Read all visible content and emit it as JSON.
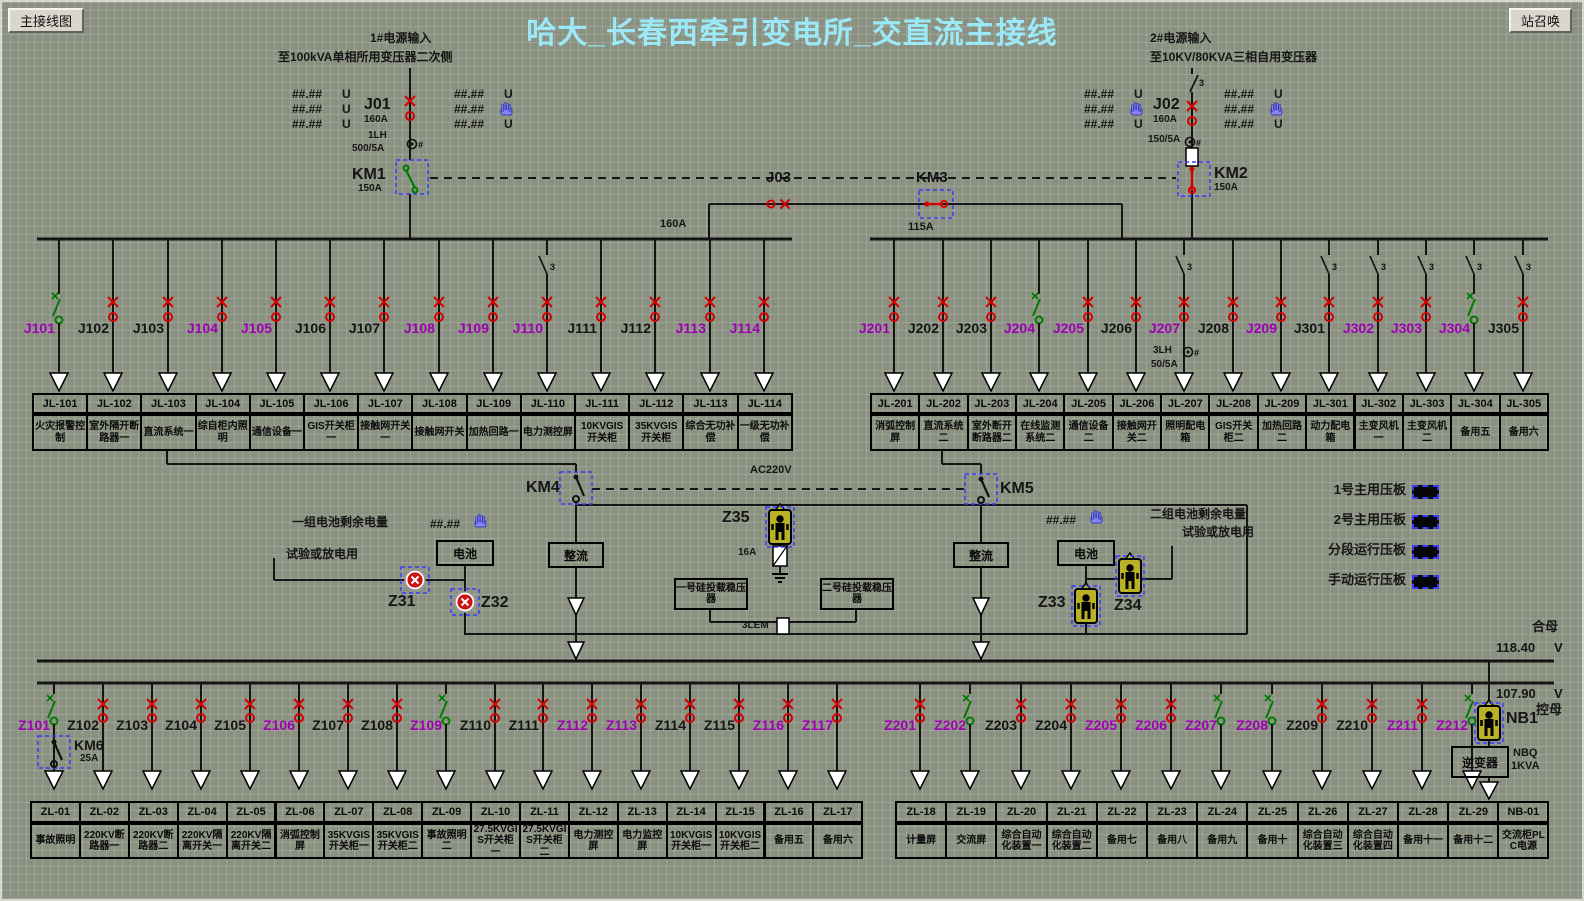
{
  "sym": {
    "three": "3",
    "hash": "#"
  },
  "header": {
    "left_button": "主接线图",
    "right_button": "站召唤",
    "title": "哈大_长春西牵引变电所_交直流主接线"
  },
  "feed1": {
    "name": "1#电源输入",
    "dest": "至100kVA单相所用变压器二次侧",
    "j": "J01",
    "j_amp": "160A",
    "ct": "1LH",
    "ct_ratio": "500/5A",
    "km": "KM1",
    "km_amp": "150A",
    "unit": "U",
    "meas_l": [
      "##.##",
      "##.##",
      "##.##"
    ],
    "meas_r": [
      "##.##",
      "##.##",
      "##.##"
    ]
  },
  "feed2": {
    "name": "2#电源输入",
    "dest": "至10KV/80KVA三相自用变压器",
    "j": "J02",
    "j_amp": "160A",
    "ct_ratio": "150/5A",
    "km": "KM2",
    "km_amp": "150A",
    "unit": "U",
    "meas_l": [
      "##.##",
      "##.##",
      "##.##"
    ],
    "meas_r": [
      "##.##",
      "##.##",
      "##.##"
    ]
  },
  "tie": {
    "j": "J03",
    "km": "KM3",
    "amp_left": "160A",
    "amp_right": "115A"
  },
  "bus1_feeders": [
    {
      "j": "J101",
      "jc": "m",
      "sw": "open",
      "box": "JL-101",
      "desc": "火灾报警控制"
    },
    {
      "j": "J102",
      "jc": "k",
      "sw": "closed",
      "box": "JL-102",
      "desc": "室外隔开断路器一"
    },
    {
      "j": "J103",
      "jc": "k",
      "sw": "closed",
      "box": "JL-103",
      "desc": "直流系统一"
    },
    {
      "j": "J104",
      "jc": "m",
      "sw": "closed",
      "box": "JL-104",
      "desc": "综自柜内照明"
    },
    {
      "j": "J105",
      "jc": "m",
      "sw": "closed",
      "box": "JL-105",
      "desc": "通信设备一"
    },
    {
      "j": "J106",
      "jc": "k",
      "sw": "closed",
      "box": "JL-106",
      "desc": "GIS开关柜一"
    },
    {
      "j": "J107",
      "jc": "k",
      "sw": "closed",
      "box": "JL-107",
      "desc": "接触网开关一"
    },
    {
      "j": "J108",
      "jc": "m",
      "sw": "closed",
      "box": "JL-108",
      "desc": "接触网开关"
    },
    {
      "j": "J109",
      "jc": "m",
      "sw": "closed",
      "box": "JL-109",
      "desc": "加热回路一"
    },
    {
      "j": "J110",
      "jc": "m",
      "sw": "closed",
      "d3": true,
      "box": "JL-110",
      "desc": "电力测控屏"
    },
    {
      "j": "J111",
      "jc": "k",
      "sw": "closed",
      "box": "JL-111",
      "desc": "10KVGIS开关柜"
    },
    {
      "j": "J112",
      "jc": "k",
      "sw": "closed",
      "box": "JL-112",
      "desc": "35KVGIS开关柜"
    },
    {
      "j": "J113",
      "jc": "m",
      "sw": "closed",
      "box": "JL-113",
      "desc": "综合无功补偿"
    },
    {
      "j": "J114",
      "jc": "m",
      "sw": "closed",
      "box": "JL-114",
      "desc": "一级无功补偿"
    }
  ],
  "bus2_feeders": [
    {
      "j": "J201",
      "jc": "m",
      "sw": "closed",
      "box": "JL-201",
      "desc": "消弧控制屏"
    },
    {
      "j": "J202",
      "jc": "k",
      "sw": "closed",
      "box": "JL-202",
      "desc": "直流系统二"
    },
    {
      "j": "J203",
      "jc": "k",
      "sw": "closed",
      "box": "JL-203",
      "desc": "室外断开断路器二"
    },
    {
      "j": "J204",
      "jc": "m",
      "sw": "open",
      "box": "JL-204",
      "desc": "在线监测系统二"
    },
    {
      "j": "J205",
      "jc": "m",
      "sw": "closed",
      "box": "JL-205",
      "desc": "通信设备二"
    },
    {
      "j": "J206",
      "jc": "k",
      "sw": "closed",
      "box": "JL-206",
      "desc": "接触网开关二"
    },
    {
      "j": "J207",
      "jc": "m",
      "sw": "closed",
      "d3": true,
      "ct": "3LH",
      "ct_ratio": "50/5A",
      "box": "JL-207",
      "desc": "照明配电箱"
    },
    {
      "j": "J208",
      "jc": "k",
      "sw": "closed",
      "box": "JL-208",
      "desc": "GIS开关柜二"
    },
    {
      "j": "J209",
      "jc": "m",
      "sw": "closed",
      "box": "JL-209",
      "desc": "加热回路二"
    },
    {
      "j": "J301",
      "jc": "k",
      "sw": "closed",
      "d3": true,
      "box": "JL-301",
      "desc": "动力配电箱"
    },
    {
      "j": "J302",
      "jc": "m",
      "sw": "closed",
      "d3": true,
      "box": "JL-302",
      "desc": "主变风机一"
    },
    {
      "j": "J303",
      "jc": "m",
      "sw": "closed",
      "d3": true,
      "box": "JL-303",
      "desc": "主变风机二"
    },
    {
      "j": "J304",
      "jc": "m",
      "sw": "open",
      "d3": true,
      "box": "JL-304",
      "desc": "备用五"
    },
    {
      "j": "J305",
      "jc": "k",
      "sw": "closed",
      "d3": true,
      "box": "JL-305",
      "desc": "备用六"
    }
  ],
  "dc": {
    "km4": "KM4",
    "km5": "KM5",
    "ac": "AC220V",
    "bat": "电池",
    "rect": "整流",
    "stab1": "一号硅投载稳压器",
    "stab2": "二号硅投载稳压器",
    "z31": "Z31",
    "z32": "Z32",
    "z33": "Z33",
    "z34": "Z34",
    "z35": "Z35",
    "z35_amp": "16A",
    "lem": "3LEM",
    "bat1_title": "一组电池剩余电量",
    "bat1_sub": "试验或放电用",
    "bat2_title": "二组电池剩余电量",
    "bat2_sub": "试验或放电用",
    "meas1": "##.##",
    "meas2": "##.##"
  },
  "legend": [
    {
      "label": "1号主用压板"
    },
    {
      "label": "2号主用压板"
    },
    {
      "label": "分段运行压板"
    },
    {
      "label": "手动运行压板"
    }
  ],
  "dcbus": {
    "bus1_label": "合母",
    "bus1_v": "118.40",
    "bus1_unit": "V",
    "bus2_v": "107.90",
    "bus2_unit": "V",
    "bus2_label": "控母",
    "km6": "KM6",
    "km6_amp": "25A",
    "nb1": "NB1",
    "inverter": "逆变器",
    "nbq_line1": "NBQ",
    "nbq_line2": "1KVA"
  },
  "row1_feeders": [
    {
      "j": "Z101",
      "jc": "m",
      "sw": "open",
      "box": "ZL-01",
      "desc": "事故照明"
    },
    {
      "j": "Z102",
      "jc": "k",
      "sw": "closed",
      "box": "ZL-02",
      "desc": "220KV断路器一"
    },
    {
      "j": "Z103",
      "jc": "k",
      "sw": "closed",
      "box": "ZL-03",
      "desc": "220KV断路器二"
    },
    {
      "j": "Z104",
      "jc": "k",
      "sw": "closed",
      "box": "ZL-04",
      "desc": "220KV隔离开关一"
    },
    {
      "j": "Z105",
      "jc": "k",
      "sw": "closed",
      "box": "ZL-05",
      "desc": "220KV隔离开关二"
    },
    {
      "j": "Z106",
      "jc": "m",
      "sw": "closed",
      "box": "ZL-06",
      "desc": "消弧控制屏"
    },
    {
      "j": "Z107",
      "jc": "k",
      "sw": "closed",
      "box": "ZL-07",
      "desc": "35KVGIS开关柜一"
    },
    {
      "j": "Z108",
      "jc": "k",
      "sw": "closed",
      "box": "ZL-08",
      "desc": "35KVGIS开关柜二"
    },
    {
      "j": "Z109",
      "jc": "m",
      "sw": "open",
      "box": "ZL-09",
      "desc": "事故照明二"
    },
    {
      "j": "Z110",
      "jc": "k",
      "sw": "closed",
      "box": "ZL-10",
      "desc": "27.5KVGIS开关柜一"
    },
    {
      "j": "Z111",
      "jc": "k",
      "sw": "closed",
      "box": "ZL-11",
      "desc": "27.5KVGIS开关柜二"
    },
    {
      "j": "Z112",
      "jc": "m",
      "sw": "closed",
      "box": "ZL-12",
      "desc": "电力测控屏"
    },
    {
      "j": "Z113",
      "jc": "m",
      "sw": "closed",
      "box": "ZL-13",
      "desc": "电力监控屏"
    },
    {
      "j": "Z114",
      "jc": "k",
      "sw": "closed",
      "box": "ZL-14",
      "desc": "10KVGIS开关柜一"
    },
    {
      "j": "Z115",
      "jc": "k",
      "sw": "closed",
      "box": "ZL-15",
      "desc": "10KVGIS开关柜二"
    },
    {
      "j": "Z116",
      "jc": "m",
      "sw": "closed",
      "box": "ZL-16",
      "desc": "备用五"
    },
    {
      "j": "Z117",
      "jc": "m",
      "sw": "closed",
      "box": "ZL-17",
      "desc": "备用六"
    }
  ],
  "row2_feeders": [
    {
      "j": "Z201",
      "jc": "m",
      "sw": "closed",
      "box": "ZL-18",
      "desc": "计量屏"
    },
    {
      "j": "Z202",
      "jc": "m",
      "sw": "open",
      "box": "ZL-19",
      "desc": "交流屏"
    },
    {
      "j": "Z203",
      "jc": "k",
      "sw": "closed",
      "box": "ZL-20",
      "desc": "综合自动化装置一"
    },
    {
      "j": "Z204",
      "jc": "k",
      "sw": "closed",
      "box": "ZL-21",
      "desc": "综合自动化装置二"
    },
    {
      "j": "Z205",
      "jc": "m",
      "sw": "closed",
      "box": "ZL-22",
      "desc": "备用七"
    },
    {
      "j": "Z206",
      "jc": "m",
      "sw": "closed",
      "box": "ZL-23",
      "desc": "备用八"
    },
    {
      "j": "Z207",
      "jc": "m",
      "sw": "open",
      "box": "ZL-24",
      "desc": "备用九"
    },
    {
      "j": "Z208",
      "jc": "m",
      "sw": "open",
      "box": "ZL-25",
      "desc": "备用十"
    },
    {
      "j": "Z209",
      "jc": "k",
      "sw": "closed",
      "box": "ZL-26",
      "desc": "综合自动化装置三"
    },
    {
      "j": "Z210",
      "jc": "k",
      "sw": "closed",
      "box": "ZL-27",
      "desc": "综合自动化装置四"
    },
    {
      "j": "Z211",
      "jc": "m",
      "sw": "closed",
      "box": "ZL-28",
      "desc": "备用十一"
    },
    {
      "j": "Z212",
      "jc": "m",
      "sw": "open",
      "box": "ZL-29",
      "desc": "备用十二"
    }
  ],
  "nb_box": {
    "box": "NB-01",
    "desc": "交流柜PLC电源"
  }
}
